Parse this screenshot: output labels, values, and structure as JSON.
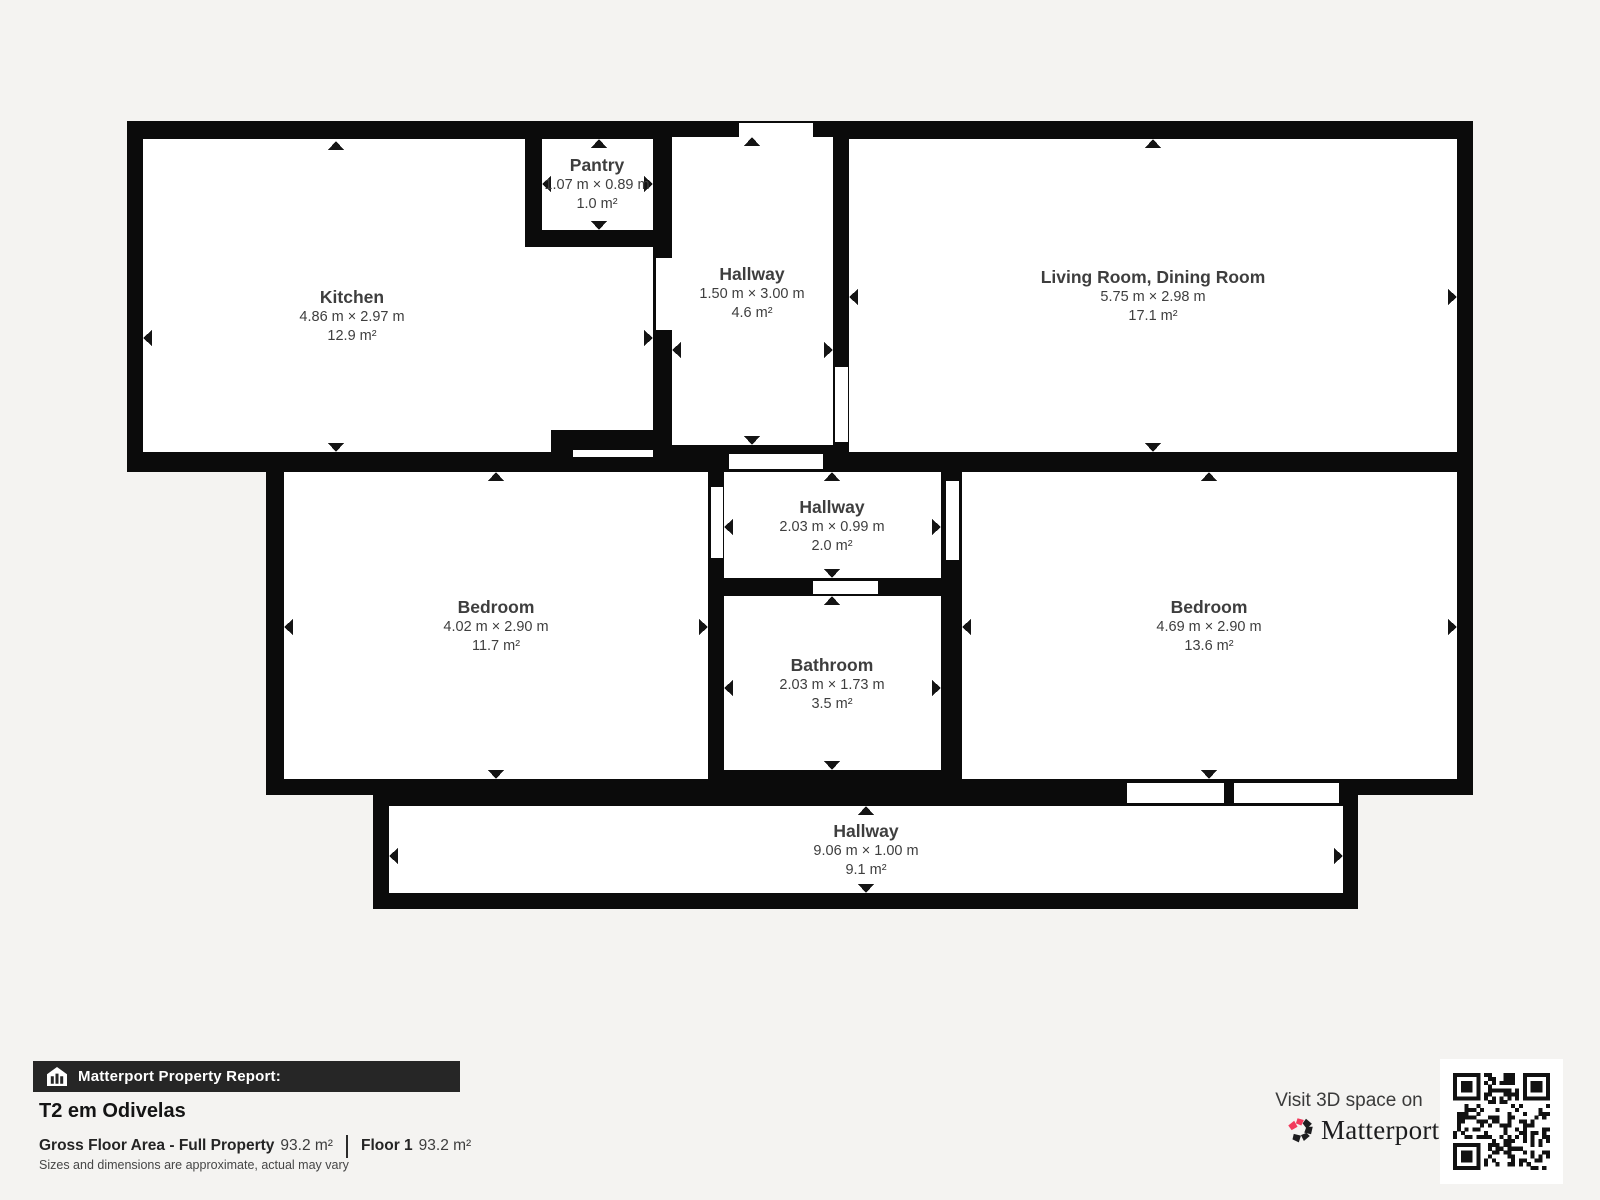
{
  "plan": {
    "wall_color": "#0b0b0b",
    "floor_color": "#ffffff",
    "label_color": "#3e3e3e",
    "rooms": [
      {
        "id": "kitchen",
        "name": "Kitchen",
        "dimensions": "4.86 m × 2.97 m",
        "area": "12.9 m²"
      },
      {
        "id": "pantry",
        "name": "Pantry",
        "dimensions": "1.07 m × 0.89 m",
        "area": "1.0 m²"
      },
      {
        "id": "hallway-top",
        "name": "Hallway",
        "dimensions": "1.50 m × 3.00 m",
        "area": "4.6 m²"
      },
      {
        "id": "living-dining",
        "name": "Living Room, Dining Room",
        "dimensions": "5.75 m × 2.98 m",
        "area": "17.1 m²"
      },
      {
        "id": "bedroom-left",
        "name": "Bedroom",
        "dimensions": "4.02 m × 2.90 m",
        "area": "11.7 m²"
      },
      {
        "id": "hallway-middle",
        "name": "Hallway",
        "dimensions": "2.03 m × 0.99 m",
        "area": "2.0 m²"
      },
      {
        "id": "bathroom",
        "name": "Bathroom",
        "dimensions": "2.03 m × 1.73 m",
        "area": "3.5 m²"
      },
      {
        "id": "bedroom-right",
        "name": "Bedroom",
        "dimensions": "4.69 m × 2.90 m",
        "area": "13.6 m²"
      },
      {
        "id": "hallway-bottom",
        "name": "Hallway",
        "dimensions": "9.06 m × 1.00 m",
        "area": "9.1 m²"
      }
    ]
  },
  "footer": {
    "report_label": "Matterport Property Report:",
    "property_title": "T2 em Odivelas",
    "gross_floor_area_label": "Gross Floor Area - Full Property",
    "gross_floor_area_value": "93.2 m²",
    "floor_label": "Floor 1",
    "floor_value": "93.2 m²",
    "disclaimer": "Sizes and dimensions are approximate, actual may vary",
    "visit_label": "Visit 3D space on",
    "brand_name": "Matterport",
    "brand_mark": "'"
  },
  "icons": {
    "report_house_icon": "house-with-bars",
    "matterport_pinwheel_icon": "pinwheel-logo-mark",
    "qr_code": "qr-code"
  },
  "colors": {
    "accent_pink": "#f23a5c",
    "bar_background": "#262626",
    "background": "#f4f3f1"
  }
}
